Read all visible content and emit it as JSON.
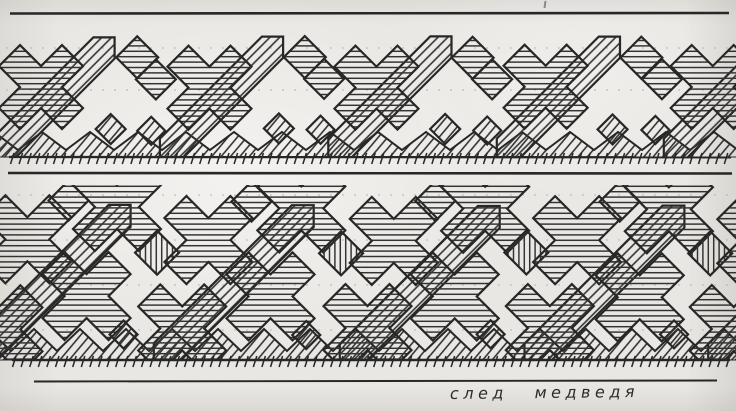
{
  "caption": {
    "text": "след медведя"
  },
  "palette": {
    "paper": "#e9e7e3",
    "ink": "#272727",
    "hatch_ink": "#333333",
    "guide": "#b6b2aa"
  },
  "canvas": {
    "width": 736,
    "height": 411
  },
  "drawing": {
    "pattern_name": "bear-track ornament, two bands, pen hatching",
    "hatches": [
      {
        "id": "hx",
        "type": "h",
        "spacing": 5.4,
        "sw": 1.5
      },
      {
        "id": "hv",
        "type": "v",
        "spacing": 5.4,
        "sw": 1.5
      },
      {
        "id": "h45",
        "type": "d",
        "angle": -45,
        "spacing": 6.9,
        "sw": 1.6
      },
      {
        "id": "h50",
        "type": "d",
        "angle": -50,
        "spacing": 7.2,
        "sw": 1.6
      }
    ],
    "rules": [
      {
        "x1": 10,
        "y1": 13.5,
        "x2": 729,
        "y2": 13,
        "w": 2.6
      },
      {
        "x1": 9,
        "y1": 157,
        "x2": 731,
        "y2": 157.3,
        "w": 2.3
      },
      {
        "x1": 8,
        "y1": 173,
        "x2": 732,
        "y2": 173.5,
        "w": 2.6
      },
      {
        "x1": 12,
        "y1": 360,
        "x2": 730,
        "y2": 360,
        "w": 2.4
      },
      {
        "x1": 34,
        "y1": 381.5,
        "x2": 717,
        "y2": 380.5,
        "w": 1.9
      }
    ],
    "marks": [
      {
        "x": 544,
        "y": 1,
        "w": 2,
        "h": 7
      }
    ],
    "bands": [
      {
        "name": "top",
        "clip": {
          "y": 24,
          "h": 133.5
        },
        "guides": [
          48,
          90
        ],
        "base": {
          "top": 132,
          "notch": 150,
          "bottom": 157.5,
          "halfstep": 24,
          "phase": -6,
          "fill": "h50"
        },
        "ticks": {
          "y1": 153,
          "y2": 164,
          "step": 8.6,
          "lean": -3.5,
          "from": 14,
          "to": 731
        },
        "period": 168,
        "start": -12,
        "count": 5,
        "elements": [
          {
            "t": "strip",
            "x1": 14,
            "y1": 150,
            "x2": 116,
            "y2": 48,
            "w": 30,
            "f": "h45"
          },
          {
            "t": "cross",
            "x": 54,
            "y": 88,
            "h": 21,
            "f": "hx"
          },
          {
            "t": "diamond",
            "x": 148,
            "y": 58,
            "h": 21,
            "f": "hx"
          },
          {
            "t": "diamond",
            "x": 169,
            "y": 80,
            "h": 20,
            "f": "hx"
          },
          {
            "t": "diamond",
            "x": 122,
            "y": 130,
            "h": 15,
            "f": "h50"
          },
          {
            "t": "diamond",
            "x": 163,
            "y": 131,
            "h": 14,
            "f": "h50"
          }
        ]
      },
      {
        "name": "bottom",
        "clip": {
          "y": 185,
          "h": 175.5
        },
        "guides": [
          195,
          240,
          285,
          330
        ],
        "base": {
          "top": 329,
          "notch": 351,
          "bottom": 360.5,
          "halfstep": 23,
          "phase": -12,
          "fill": "h50"
        },
        "ticks": {
          "y1": 356,
          "y2": 367,
          "step": 8.6,
          "lean": -3.5,
          "from": 16,
          "to": 731
        },
        "period": 184,
        "start": -30,
        "count": 5,
        "elements": [
          {
            "t": "strip",
            "x1": 12,
            "y1": 354,
            "x2": 150,
            "y2": 216,
            "w": 31,
            "f": "h45"
          },
          {
            "t": "cross",
            "x": 56,
            "y": 240,
            "h": 22,
            "f": "hx"
          },
          {
            "t": "cross",
            "x": 146,
            "y": 208,
            "h": 22,
            "f": "hx"
          },
          {
            "t": "cross",
            "x": 118,
            "y": 296,
            "h": 22,
            "f": "hx"
          },
          {
            "t": "cross",
            "x": 28,
            "y": 328,
            "h": 22,
            "f": "hx"
          },
          {
            "t": "diamond",
            "x": 188,
            "y": 252,
            "h": 22,
            "f": "hv"
          },
          {
            "t": "diamond",
            "x": 98,
            "y": 200,
            "h": 20,
            "f": "hx"
          },
          {
            "t": "diamond",
            "x": 152,
            "y": 334,
            "h": 14,
            "f": "h50"
          }
        ]
      }
    ]
  }
}
